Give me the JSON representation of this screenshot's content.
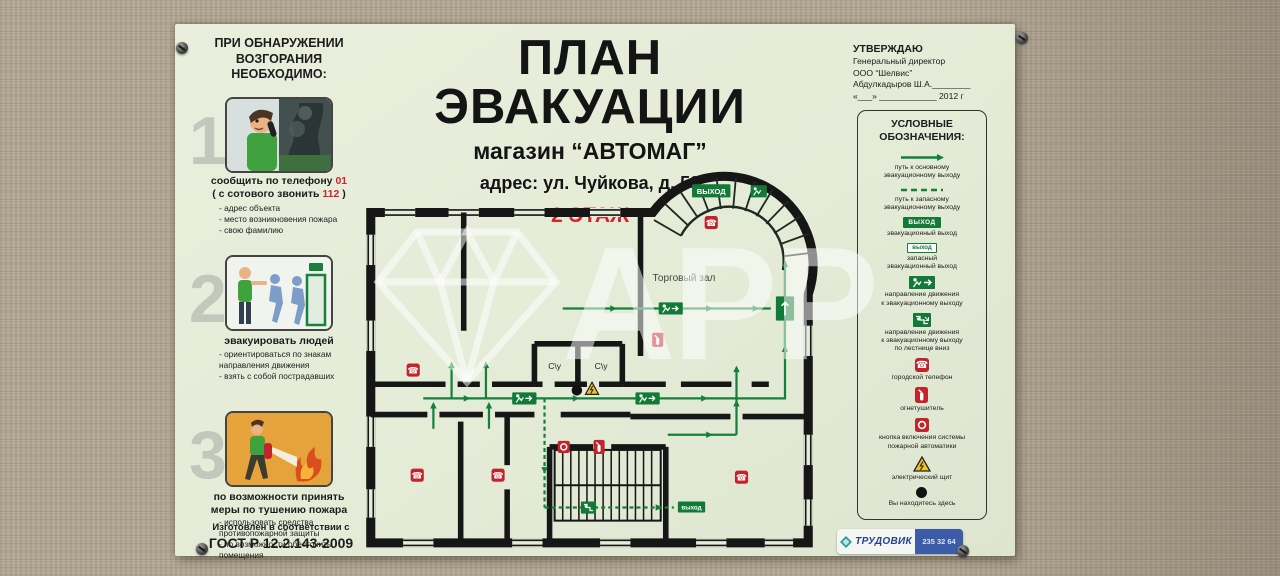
{
  "watermark": {
    "text": "АРР"
  },
  "poster": {
    "title": "ПЛАН ЭВАКУАЦИИ",
    "subtitle": "магазин “АВТОМАГ”",
    "address": "адрес: ул. Чуйкова, д. 58",
    "floor": "2 ЭТАЖ",
    "instructions": {
      "header": "ПРИ ОБНАРУЖЕНИИ\nВОЗГОРАНИЯ\nНЕОБХОДИМО:",
      "steps": [
        {
          "number": "1",
          "caption_pre": "сообщить по телефону ",
          "caption_num": "01",
          "caption2_pre": "( с сотового звонить ",
          "caption2_num": "112",
          "caption2_post": " )",
          "bullets": [
            "- адрес объекта",
            "- место возникновения пожара",
            "- свою фамилию"
          ]
        },
        {
          "number": "2",
          "caption": "эвакуировать людей",
          "bullets": [
            "- ориентироваться по знакам\nнаправления движения",
            "- взять с собой пострадавших"
          ]
        },
        {
          "number": "3",
          "caption": "по возможности принять\nмеры по тушению пожара",
          "bullets": [
            "- использовать средства\nпротивопожарной защиты",
            "- по возможности обесточить\nпомещения"
          ]
        }
      ],
      "gost_line1": "Изготовлен в соответствии с",
      "gost_line2": "ГОСТ Р 12.2.143-2009"
    },
    "approval": {
      "line1": "УТВЕРЖДАЮ",
      "line2": "Генеральный директор",
      "line3": "ООО “Шелвис”",
      "line4": "Абдулкадыров Ш.А.________",
      "line5": "«___» ____________ 2012 г"
    },
    "legend": {
      "title": "УСЛОВНЫЕ\nОБОЗНАЧЕНИЯ:",
      "exit_text": "ВЫХОД",
      "exit2_text": "выход",
      "items": [
        {
          "label": "путь к основному\nэвакуационному выходу"
        },
        {
          "label": "путь к запасному\nэвакуационному выходу"
        },
        {
          "label": "эвакуационный выход"
        },
        {
          "label": "запасный\nэвакуационный выход"
        },
        {
          "label": "направление движения\nк эвакуационному выходу"
        },
        {
          "label": "направление движения\nк эвакуационному выходу\nпо лестнице вниз"
        },
        {
          "label": "городской телефон"
        },
        {
          "label": "огнетушитель"
        },
        {
          "label": "кнопка включения системы\nпожарной автоматики"
        },
        {
          "label": "электрический щит"
        },
        {
          "label": "Вы находитесь здесь"
        }
      ]
    },
    "plan": {
      "hall": "Торговый зал",
      "wc": "С\\у",
      "exit_main": "ВЫХОД",
      "exit_small": "выход"
    },
    "vendor": {
      "brand": "ТРУДОВИК",
      "phone": "235 32 64"
    }
  },
  "colors": {
    "route_green": "#15803b",
    "sign_green": "#117a37",
    "icon_red": "#c3232a",
    "poster_bg": "#e6ecd9",
    "wall_beige": "#b2a794"
  }
}
